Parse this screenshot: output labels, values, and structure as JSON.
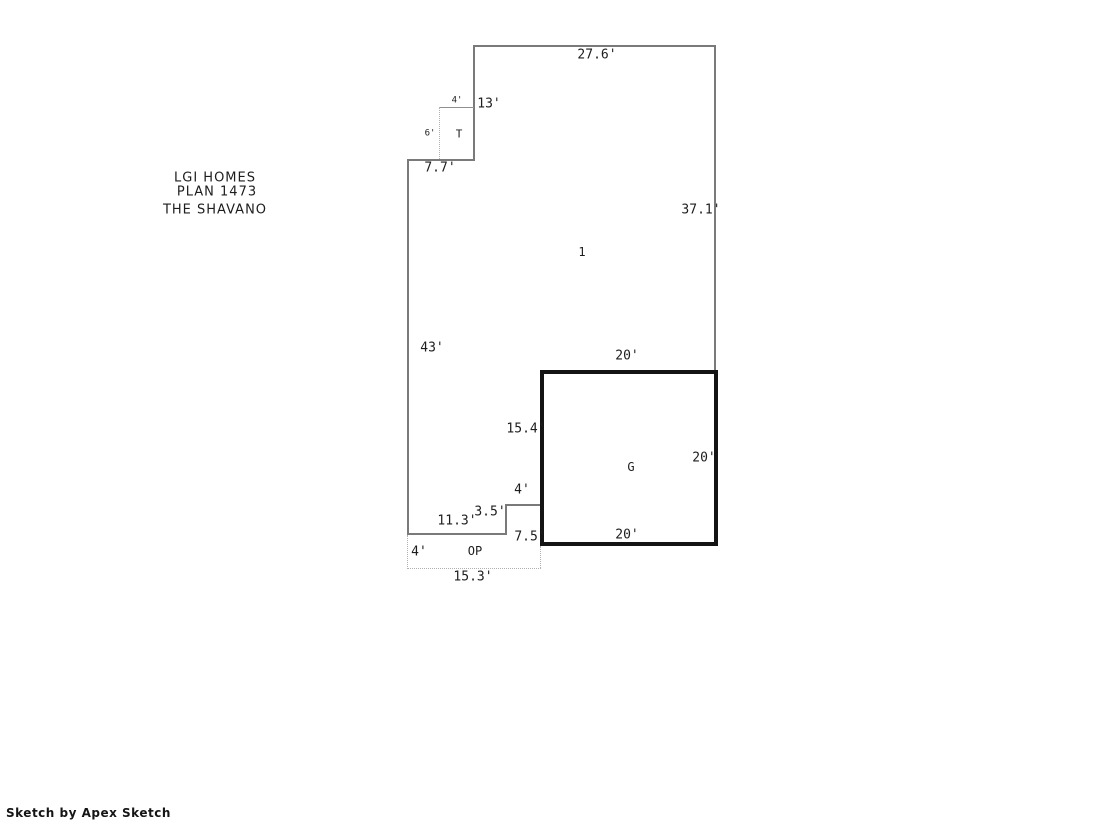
{
  "sketch": {
    "title_block": {
      "line1": "LGI HOMES",
      "line2": "PLAN 1473",
      "line3": "THE SHAVANO"
    },
    "area_labels": {
      "living": "1",
      "garage": "G",
      "stoop": "T",
      "porch": "OP"
    },
    "dims": {
      "top": "27.6'",
      "upper_left_wall": "13'",
      "stoop_width": "4'",
      "stoop_depth": "6'",
      "upper_step": "7.7'",
      "right_wall": "37.1'",
      "left_wall": "43'",
      "garage_top": "20'",
      "garage_left_upper": "15.4'",
      "garage_right": "20'",
      "garage_bottom": "20'",
      "jog_width": "4'",
      "jog_height": "3.5'",
      "bottom_wall": "11.3'",
      "porch_right": "7.5'",
      "porch_depth": "4'",
      "porch_width": "15.3'"
    },
    "footer": {
      "credit": "Sketch by Apex Sketch"
    },
    "colors": {
      "wall": "#7a7a7a",
      "garage_wall": "#141414",
      "dotted": "#b0b0b0",
      "stoop_line": "#8f8f8f",
      "text": "#1d1d1d"
    }
  }
}
